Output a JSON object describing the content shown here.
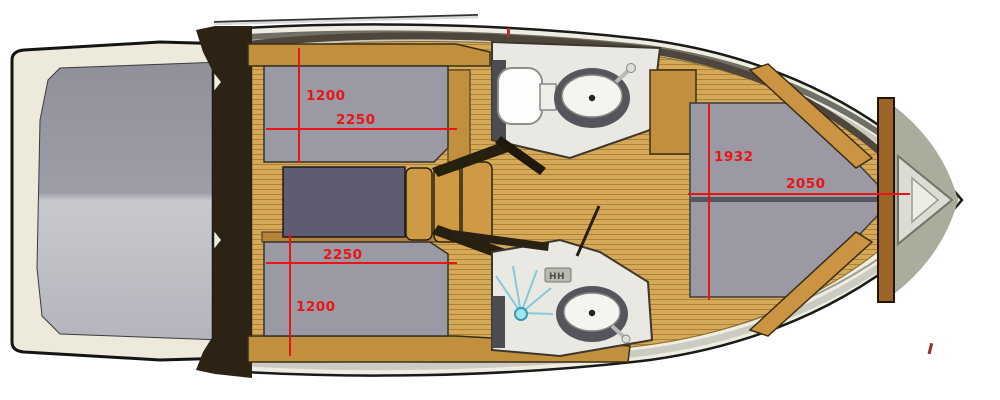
{
  "meta": {
    "title": "Motor yacht interior deck plan, bow pointing right",
    "diagram_type": "boat-floor-plan"
  },
  "dimensions": {
    "aft_cabin_port": {
      "width": "1200",
      "length": "2250"
    },
    "aft_cabin_starboard": {
      "length": "2250",
      "width": "1200"
    },
    "bow_cabin": {
      "width": "1932",
      "length": "2050"
    }
  },
  "icons": {
    "vent_label": "HH"
  },
  "areas": [
    "swim-platform",
    "engine-hatch",
    "transom-wall",
    "aft-berth-port",
    "aft-berth-starboard",
    "dinette-table",
    "companionway-steps",
    "teak-corridor",
    "head-toilet",
    "head-sink",
    "shower-head",
    "shower-sink",
    "bow-v-berth",
    "bow-bulkhead",
    "anchor-locker"
  ],
  "colors": {
    "hull_cream": "#efede0",
    "hull_outline": "#1a1a1a",
    "gunwale_dark": "#6f6f67",
    "gunwale_light": "#c9c9c0",
    "deck_olive": "#aaac9c",
    "teak_light": "#d4a958",
    "teak_dark": "#b08038",
    "wood_trim": "#c1903f",
    "dark_wood": "#2c2315",
    "berth_gray": "#9b9aa4",
    "table_slate": "#5e5b72",
    "bathroom_floor": "#e9e8e2",
    "counter_gray": "#55555b",
    "shower_blue": "#7ec8d8",
    "dimension_red": "#e91414"
  }
}
